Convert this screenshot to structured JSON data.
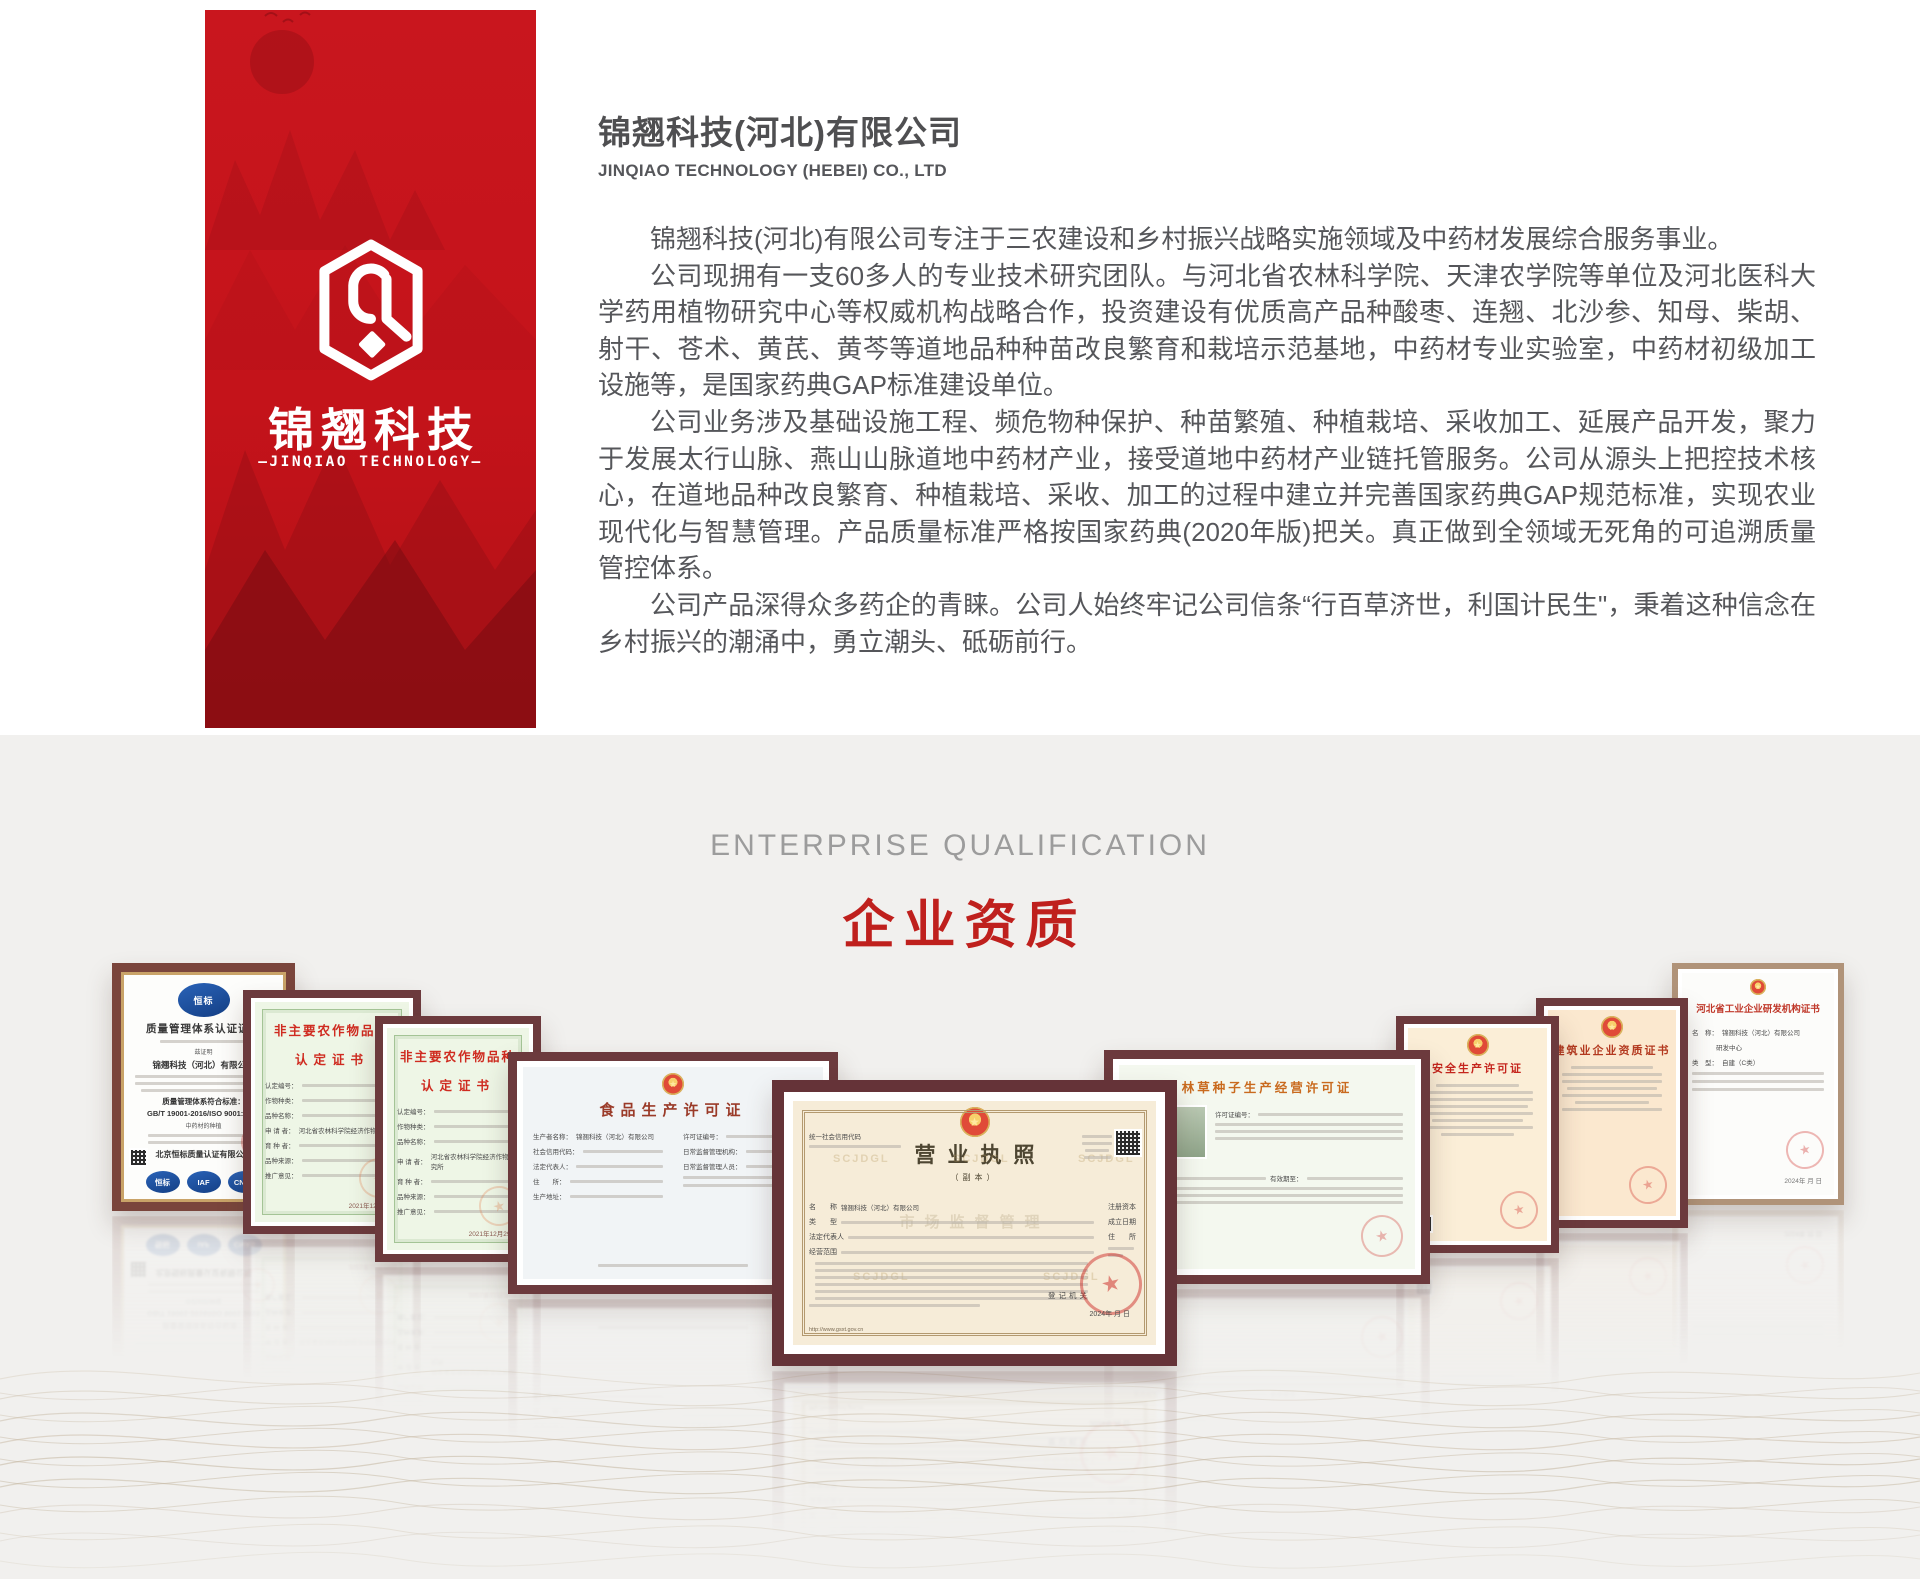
{
  "banner": {
    "logo_title": "锦翘科技",
    "logo_subtitle": "—JINQIAO TECHNOLOGY—"
  },
  "header": {
    "title": "锦翘科技(河北)有限公司",
    "subtitle": "JINQIAO TECHNOLOGY (HEBEI) CO., LTD"
  },
  "about": {
    "paragraphs": [
      "锦翘科技(河北)有限公司专注于三农建设和乡村振兴战略实施领域及中药材发展综合服务事业。",
      "公司现拥有一支60多人的专业技术研究团队。与河北省农林科学院、天津农学院等单位及河北医科大学药用植物研究中心等权威机构战略合作，投资建设有优质高产品种酸枣、连翘、北沙参、知母、柴胡、射干、苍术、黄芪、黄芩等道地品种种苗改良繁育和栽培示范基地，中药材专业实验室，中药材初级加工设施等，是国家药典GAP标准建设单位。",
      "公司业务涉及基础设施工程、频危物种保护、种苗繁殖、种植栽培、采收加工、延展产品开发，聚力于发展太行山脉、燕山山脉道地中药材产业，接受道地中药材产业链托管服务。公司从源头上把控技术核心，在道地品种改良繁育、种植栽培、采收、加工的过程中建立并完善国家药典GAP规范标准，实现农业现代化与智慧管理。产品质量标准严格按国家药典(2020年版)把关。真正做到全领域无死角的可追溯质量管控体系。",
      "公司产品深得众多药企的青睐。公司人始终牢记公司信条“行百草济世，利国计民生\"，秉着这种信念在乡村振兴的潮涌中，勇立潮头、砥砺前行。"
    ]
  },
  "qualification": {
    "label_en": "ENTERPRISE QUALIFICATION",
    "label_zh": "企业资质"
  },
  "colors": {
    "banner_red": "#c9161e",
    "heading_red": "#bf201d",
    "frame_maroon": "#6c3a3d",
    "section_bg": "#f1f0ee"
  },
  "certificates": [
    {
      "logo_text": "恒标",
      "title": "质量管理体系认证证书",
      "attest": "兹证明",
      "company": "锦翘科技（河北）有限公司",
      "standard_heading": "质量管理体系符合标准：",
      "standard": "GB/T 19001-2016/ISO 9001:2015",
      "scope": "中药材的种植",
      "issuer": "北京恒标质量认证有限公司",
      "badges": [
        "恒标",
        "IAF",
        "CNAS"
      ]
    },
    {
      "title_line1": "非主要农作物品种",
      "title_line2": "认定证书",
      "fields": [
        "认定编号：",
        "作物种类：",
        "品种名称：",
        "申 请 者：",
        "育 种 者：",
        "品种来源：",
        "推广意见："
      ],
      "applicant": "河北省农林科学院经济作物研究所",
      "date": "2021年12月29日"
    },
    {
      "title_line1": "非主要农作物品种",
      "title_line2": "认定证书",
      "fields": [
        "认定编号：",
        "作物种类：",
        "品种名称：",
        "申 请 者：",
        "育 种 者：",
        "品种来源：",
        "推广意见："
      ],
      "applicant": "河北省农林科学院经济作物研究所",
      "date": "2021年12月29日"
    },
    {
      "title": "食品生产许可证",
      "fields_left": [
        "生产者名称：",
        "社会信用代码：",
        "法定代表人：",
        "住　　所：",
        "生产地址："
      ],
      "fields_right": [
        "许可证编号：",
        "日常监督管理机构：",
        "日常监督管理人员："
      ],
      "company": "锦翘科技（河北）有限公司"
    },
    {
      "code_label": "统一社会信用代码",
      "title": "营业执照",
      "subtitle": "（副本）",
      "left_labels": [
        "名　　称",
        "类　　型",
        "法定代表人",
        "经营范围"
      ],
      "right_labels": [
        "注册资本",
        "成立日期",
        "住　　所"
      ],
      "company": "锦翘科技（河北）有限公司",
      "registrar_label": "登记机关",
      "date": "2024年 月 日",
      "url": "http://www.gsxt.gov.cn",
      "watermark": "SCJDGL",
      "center_watermark": "市场监督管理"
    },
    {
      "title": "林草种子生产经营许可证",
      "fields": [
        "许可证编号：",
        "发证机关：",
        "有效期至："
      ]
    },
    {
      "title": "安全生产许可证"
    },
    {
      "title": "建筑业企业资质证书"
    },
    {
      "title": "河北省工业企业研发机构证书",
      "name_label": "名　称：",
      "company": "锦翘科技（河北）有限公司",
      "company2": "研发中心",
      "type_label": "类　型：",
      "type_value": "自建（C类）",
      "date": "2024年 月 日"
    }
  ]
}
